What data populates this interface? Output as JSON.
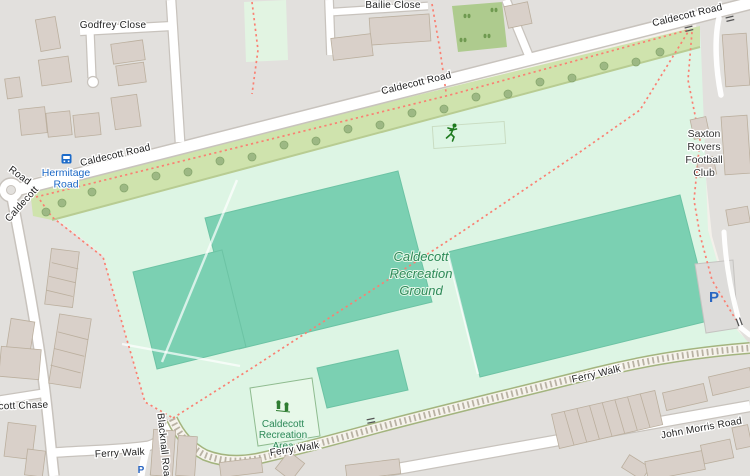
{
  "map_type": "openstreetmap-style street map",
  "colors": {
    "residential": "#e2e0dd",
    "park": "#ddf5e4",
    "grass_strip": "#cfe3ad",
    "scrub": "#aecb8e",
    "pitch": "#7bd0b2",
    "building": "#d9d0c9",
    "building_outline": "#bbaf9e",
    "road_fill": "#ffffff",
    "road_casing": "#c8c3bd",
    "footpath_dash": "#fa8072",
    "label_road": "#222222",
    "label_park": "#2f8a58",
    "label_transit": "#1b67c5",
    "parking_blue": "#2a66c2",
    "tree": "#9db884"
  },
  "labels": {
    "godfrey_close": "Godfrey Close",
    "bailie_close": "Bailie Close",
    "caldecott_road": "Caldecott Road",
    "roundabout_caldecott": "Caldecott",
    "roundabout_road": "Road",
    "hermitage_1": "Hermitage",
    "hermitage_2": "Road",
    "saxton_1": "Saxton",
    "saxton_2": "Rovers",
    "saxton_3": "Football",
    "saxton_4": "Club",
    "park_1": "Caldecott",
    "park_2": "Recreation",
    "park_3": "Ground",
    "rec_area_1": "Caldecott",
    "rec_area_2": "Recreation",
    "rec_area_3": "Area",
    "ferry_walk": "Ferry Walk",
    "john_morris_road": "John Morris Road",
    "caldecott_chase": "Caldecott Chase",
    "blacknall_road": "Blacknall Road",
    "parking": "P"
  },
  "icons": {
    "bus_stop": "bus-stop-icon",
    "fitness": "fitness-runner-icon",
    "playground": "playground-icon",
    "parking": "parking-p",
    "gates": "gate-icon"
  }
}
